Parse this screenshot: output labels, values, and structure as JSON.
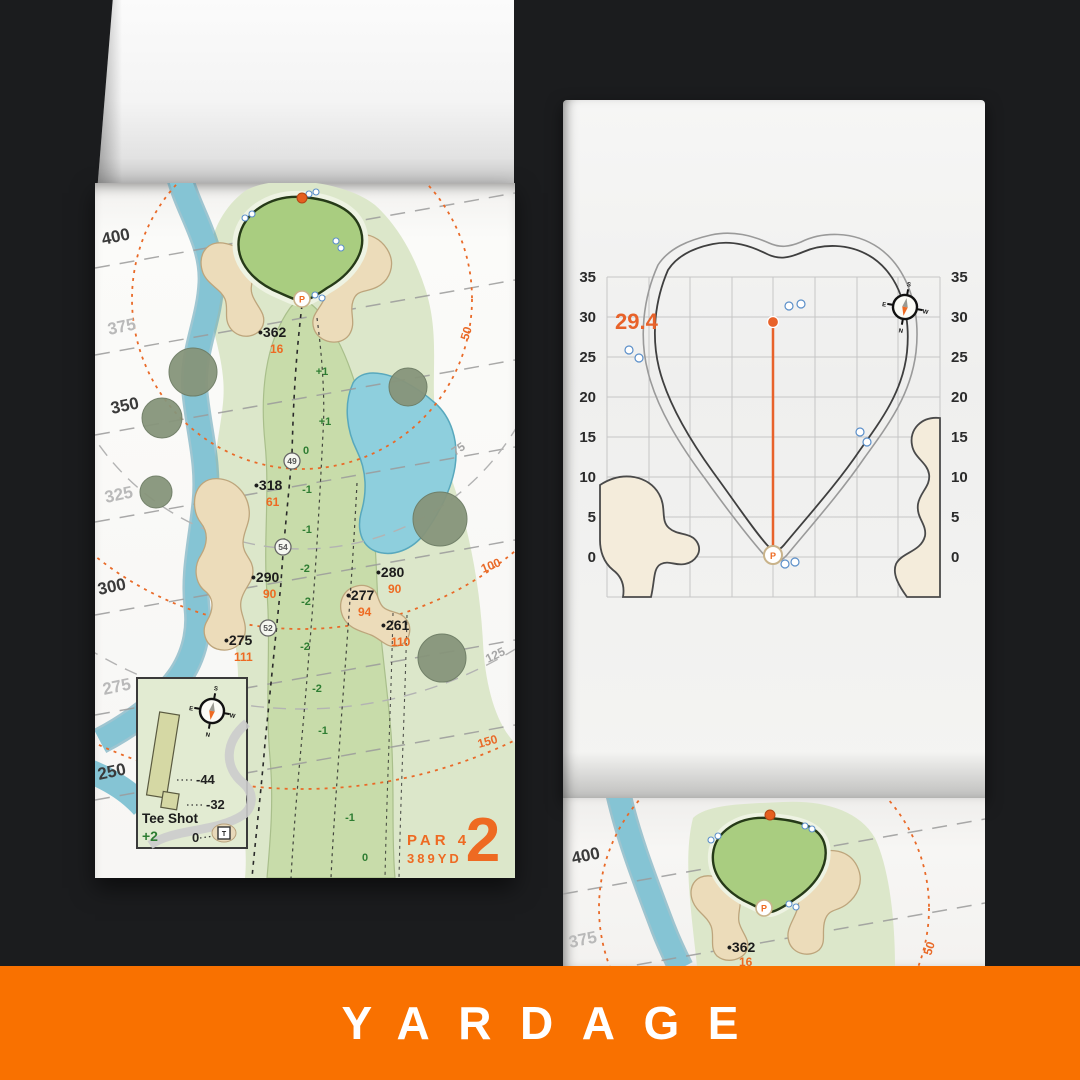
{
  "banner": {
    "label": "YARDAGE",
    "bg": "#f97100"
  },
  "left_page": {
    "hole_number": "2",
    "par": "PAR 4",
    "yards": "389YD",
    "margin_labels": [
      {
        "t": "400"
      },
      {
        "t": "375"
      },
      {
        "t": "350"
      },
      {
        "t": "325"
      },
      {
        "t": "300"
      },
      {
        "t": "275"
      },
      {
        "t": "250"
      }
    ],
    "arc_labels": [
      {
        "t": "50"
      },
      {
        "t": "75"
      },
      {
        "t": "100"
      },
      {
        "t": "125"
      },
      {
        "t": "150"
      }
    ],
    "yardage_points": [
      {
        "dist": "•362",
        "pin": "16"
      },
      {
        "dist": "•318",
        "pin": "61"
      },
      {
        "dist": "•290",
        "pin": "90"
      },
      {
        "dist": "•280",
        "pin": "90"
      },
      {
        "dist": "•277",
        "pin": "94"
      },
      {
        "dist": "•261",
        "pin": "110"
      },
      {
        "dist": "•275",
        "pin": "111"
      }
    ],
    "waypoints": [
      "49",
      "54",
      "52"
    ],
    "slopes": [
      "+1",
      "+1",
      "0",
      "-1",
      "-1",
      "-2",
      "-2",
      "-2",
      "-2",
      "-1",
      "-1",
      "0"
    ],
    "pin_label": "P",
    "inset": {
      "title": "Tee Shot",
      "score": "+2",
      "carry_left": "-44",
      "carry_right": "-32",
      "tee_zero": "0",
      "tee_marker": "T"
    },
    "compass": {
      "n": "N",
      "s": "S",
      "e": "E",
      "w": "W"
    }
  },
  "right_page": {
    "depth": "29.4",
    "ticks": [
      "35",
      "30",
      "25",
      "20",
      "15",
      "10",
      "5",
      "0"
    ],
    "pin_label": "P",
    "compass": {
      "n": "N",
      "s": "S",
      "e": "E",
      "w": "W"
    }
  },
  "next_page": {
    "margin_labels": [
      {
        "t": "400"
      },
      {
        "t": "375"
      }
    ],
    "point": {
      "dist": "•362",
      "pin": "16"
    },
    "arc_label": "50"
  }
}
